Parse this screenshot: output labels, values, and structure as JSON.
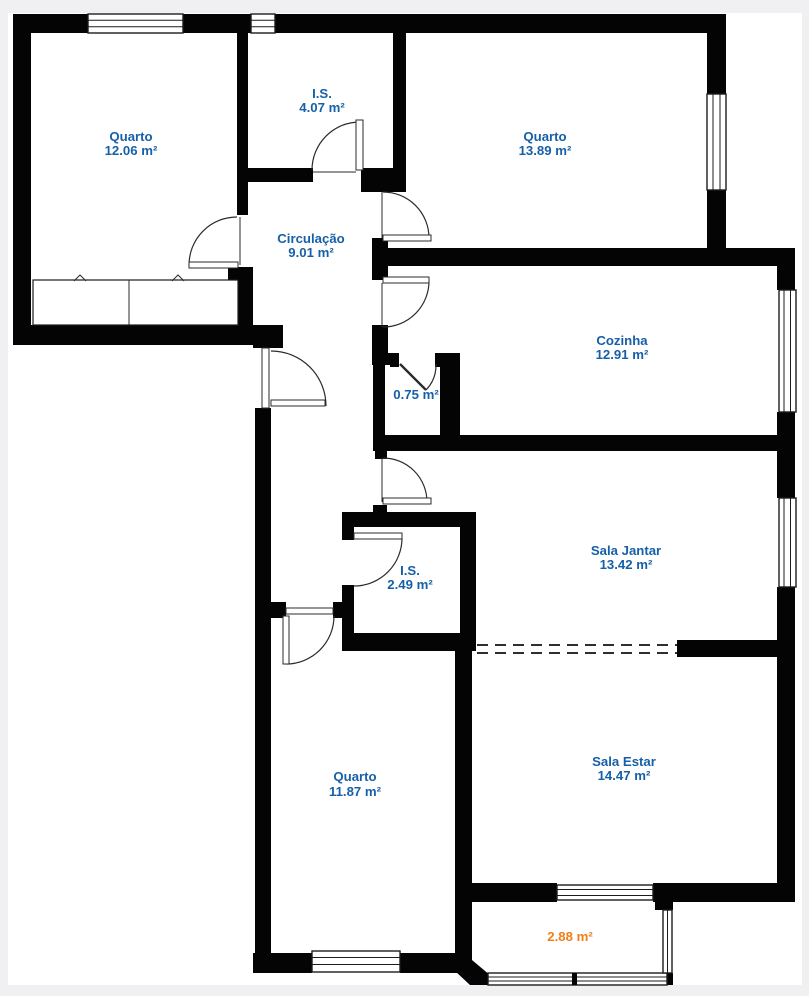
{
  "palette": {
    "wall": "#040404",
    "canvas": "#ffffff",
    "page_border": "#f0f0f2",
    "room_label_blue": "#1560a8",
    "balcony_label_orange": "#ef8018"
  },
  "rooms": [
    {
      "id": "quarto-1",
      "name": "Quarto",
      "area": "12.06 m²"
    },
    {
      "id": "is-1",
      "name": "I.S.",
      "area": "4.07 m²"
    },
    {
      "id": "quarto-2",
      "name": "Quarto",
      "area": "13.89 m²"
    },
    {
      "id": "circulacao",
      "name": "Circulação",
      "area": "9.01 m²"
    },
    {
      "id": "cozinha",
      "name": "Cozinha",
      "area": "12.91 m²"
    },
    {
      "id": "despensa",
      "name": "",
      "area": "0.75 m²"
    },
    {
      "id": "sala-jantar",
      "name": "Sala Jantar",
      "area": "13.42 m²"
    },
    {
      "id": "is-2",
      "name": "I.S.",
      "area": "2.49 m²"
    },
    {
      "id": "quarto-3",
      "name": "Quarto",
      "area": "11.87 m²"
    },
    {
      "id": "sala-estar",
      "name": "Sala Estar",
      "area": "14.47 m²"
    },
    {
      "id": "varanda",
      "name": "",
      "area": "2.88 m²"
    }
  ]
}
